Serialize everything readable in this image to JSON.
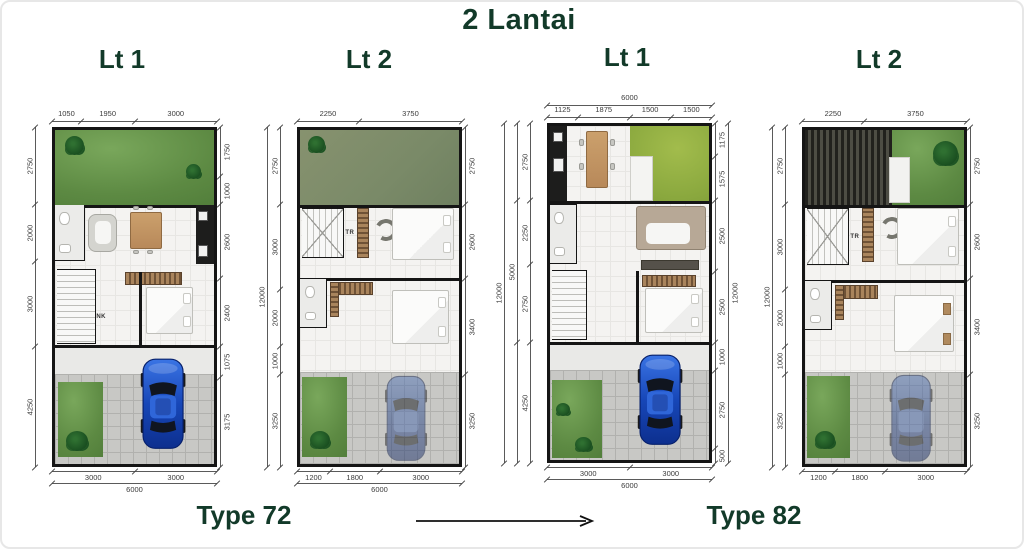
{
  "title": "2 Lantai",
  "captions": {
    "type72": "Type 72",
    "type82": "Type 82"
  },
  "colors": {
    "heading": "#123a29",
    "dim": "#3b3b3b",
    "wall": "#151515",
    "garden_green": "#5d8a43",
    "bright_garden": "#8aa83e",
    "roof_garden": "#7a8a68",
    "roof_slats": "#3c3c34",
    "carport_gray": "#c8c8c5",
    "car_blue": "#1d4fc2"
  },
  "plans": [
    {
      "header": "Lt 1",
      "stair_label": "NK",
      "width_mm": 6000,
      "height_mm": 12000,
      "chains": {
        "top": [
          {
            "segments": [
              {
                "mm": 1050,
                "t": "1050"
              },
              {
                "mm": 1950,
                "t": "1950"
              },
              {
                "mm": 3000,
                "t": "3000"
              }
            ]
          }
        ],
        "bottom": [
          {
            "segments": [
              {
                "mm": 3000,
                "t": "3000"
              },
              {
                "mm": 3000,
                "t": "3000"
              }
            ]
          },
          {
            "segments": [
              {
                "mm": 6000,
                "t": "6000"
              }
            ]
          }
        ],
        "left": [
          {
            "segments": [
              {
                "mm": 2750,
                "t": "2750"
              },
              {
                "mm": 2000,
                "t": "2000"
              },
              {
                "mm": 3000,
                "t": "3000"
              },
              {
                "mm": 4250,
                "t": "4250"
              }
            ]
          }
        ],
        "right": [
          {
            "segments": [
              {
                "mm": 1750,
                "t": "1750"
              },
              {
                "mm": 1000,
                "t": "1000"
              },
              {
                "mm": 2600,
                "t": "2600"
              },
              {
                "mm": 2400,
                "t": "2400"
              },
              {
                "mm": 1075,
                "t": "1075"
              },
              {
                "mm": 3175,
                "t": "3175"
              }
            ]
          }
        ]
      }
    },
    {
      "header": "Lt 2",
      "stair_label": "TR",
      "width_mm": 6000,
      "height_mm": 12000,
      "chains": {
        "top": [
          {
            "segments": [
              {
                "mm": 2250,
                "t": "2250"
              },
              {
                "mm": 3750,
                "t": "3750"
              }
            ]
          }
        ],
        "bottom": [
          {
            "segments": [
              {
                "mm": 1200,
                "t": "1200"
              },
              {
                "mm": 1800,
                "t": "1800"
              },
              {
                "mm": 3000,
                "t": "3000"
              }
            ]
          },
          {
            "segments": [
              {
                "mm": 6000,
                "t": "6000"
              }
            ]
          }
        ],
        "left": [
          {
            "segments": [
              {
                "mm": 2750,
                "t": "2750"
              },
              {
                "mm": 3000,
                "t": "3000"
              },
              {
                "mm": 2000,
                "t": "2000"
              },
              {
                "mm": 1000,
                "t": "1000"
              },
              {
                "mm": 3250,
                "t": "3250"
              }
            ]
          },
          {
            "segments": [
              {
                "mm": 12000,
                "t": "12000"
              }
            ]
          }
        ],
        "right": [
          {
            "segments": [
              {
                "mm": 2750,
                "t": "2750"
              },
              {
                "mm": 2600,
                "t": "2600"
              },
              {
                "mm": 3400,
                "t": "3400"
              },
              {
                "mm": 3250,
                "t": "3250"
              }
            ]
          }
        ]
      }
    },
    {
      "header": "Lt 1",
      "stair_label": "",
      "width_mm": 6000,
      "height_mm": 12000,
      "chains": {
        "top": [
          {
            "segments": [
              {
                "mm": 1125,
                "t": "1125"
              },
              {
                "mm": 1875,
                "t": "1875"
              },
              {
                "mm": 1500,
                "t": "1500"
              },
              {
                "mm": 1500,
                "t": "1500"
              }
            ]
          },
          {
            "segments": [
              {
                "mm": 6000,
                "t": "6000"
              }
            ]
          }
        ],
        "bottom": [
          {
            "segments": [
              {
                "mm": 3000,
                "t": "3000"
              },
              {
                "mm": 3000,
                "t": "3000"
              }
            ]
          },
          {
            "segments": [
              {
                "mm": 6000,
                "t": "6000"
              }
            ]
          }
        ],
        "left": [
          {
            "segments": [
              {
                "mm": 2750,
                "t": "2750"
              },
              {
                "mm": 2250,
                "t": "2250"
              },
              {
                "mm": 2750,
                "t": "2750"
              },
              {
                "mm": 4250,
                "t": "4250"
              }
            ]
          },
          {
            "segments": [
              {
                "mm": 2750,
                "t": ""
              },
              {
                "mm": 5000,
                "t": "5000"
              },
              {
                "mm": 4250,
                "t": ""
              }
            ]
          },
          {
            "segments": [
              {
                "mm": 12000,
                "t": "12000"
              }
            ]
          }
        ],
        "right": [
          {
            "segments": [
              {
                "mm": 1175,
                "t": "1175"
              },
              {
                "mm": 1575,
                "t": "1575"
              },
              {
                "mm": 2500,
                "t": "2500"
              },
              {
                "mm": 2500,
                "t": "2500"
              },
              {
                "mm": 1000,
                "t": "1000"
              },
              {
                "mm": 2750,
                "t": "2750"
              },
              {
                "mm": 500,
                "t": "500"
              }
            ]
          },
          {
            "segments": [
              {
                "mm": 12000,
                "t": "12000"
              }
            ]
          }
        ]
      }
    },
    {
      "header": "Lt 2",
      "stair_label": "TR",
      "width_mm": 6000,
      "height_mm": 12000,
      "chains": {
        "top": [
          {
            "segments": [
              {
                "mm": 2250,
                "t": "2250"
              },
              {
                "mm": 3750,
                "t": "3750"
              }
            ]
          }
        ],
        "bottom": [
          {
            "segments": [
              {
                "mm": 1200,
                "t": "1200"
              },
              {
                "mm": 1800,
                "t": "1800"
              },
              {
                "mm": 3000,
                "t": "3000"
              }
            ]
          }
        ],
        "left": [
          {
            "segments": [
              {
                "mm": 2750,
                "t": "2750"
              },
              {
                "mm": 3000,
                "t": "3000"
              },
              {
                "mm": 2000,
                "t": "2000"
              },
              {
                "mm": 1000,
                "t": "1000"
              },
              {
                "mm": 3250,
                "t": "3250"
              }
            ]
          },
          {
            "segments": [
              {
                "mm": 12000,
                "t": "12000"
              }
            ]
          }
        ],
        "right": [
          {
            "segments": [
              {
                "mm": 2750,
                "t": "2750"
              },
              {
                "mm": 2600,
                "t": "2600"
              },
              {
                "mm": 3400,
                "t": "3400"
              },
              {
                "mm": 3250,
                "t": "3250"
              }
            ]
          }
        ]
      }
    }
  ]
}
